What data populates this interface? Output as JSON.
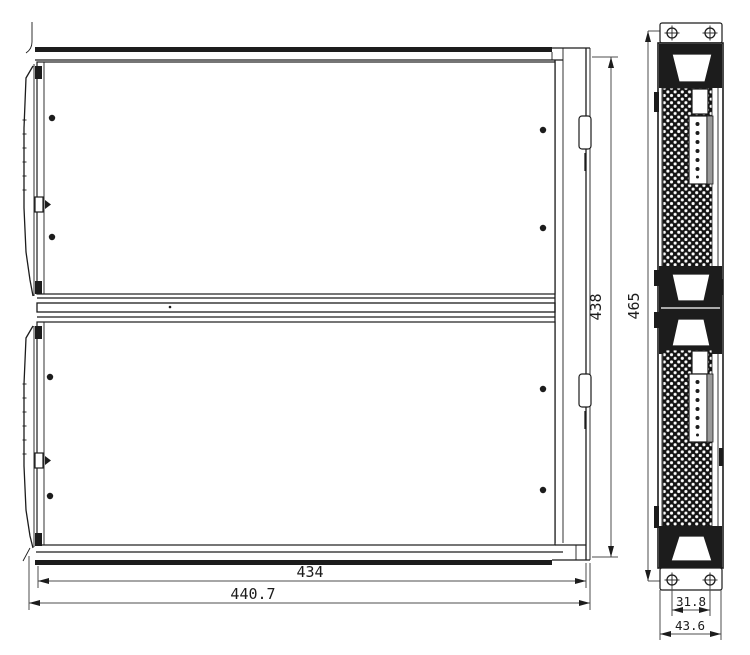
{
  "drawing": {
    "type": "technical-drawing-two-views",
    "dimensions": {
      "width_inner": "434",
      "width_overall": "440.7",
      "depth_body": "438",
      "height_overall": "465",
      "bracket_hole_spacing": "31.8",
      "bracket_width": "43.6"
    },
    "colors": {
      "background": "#ffffff",
      "line": "#1c1c1c",
      "dim_line": "#4d4d4d",
      "divider_fill": "#8c8c8c",
      "mesh_fill": "#141414"
    }
  }
}
